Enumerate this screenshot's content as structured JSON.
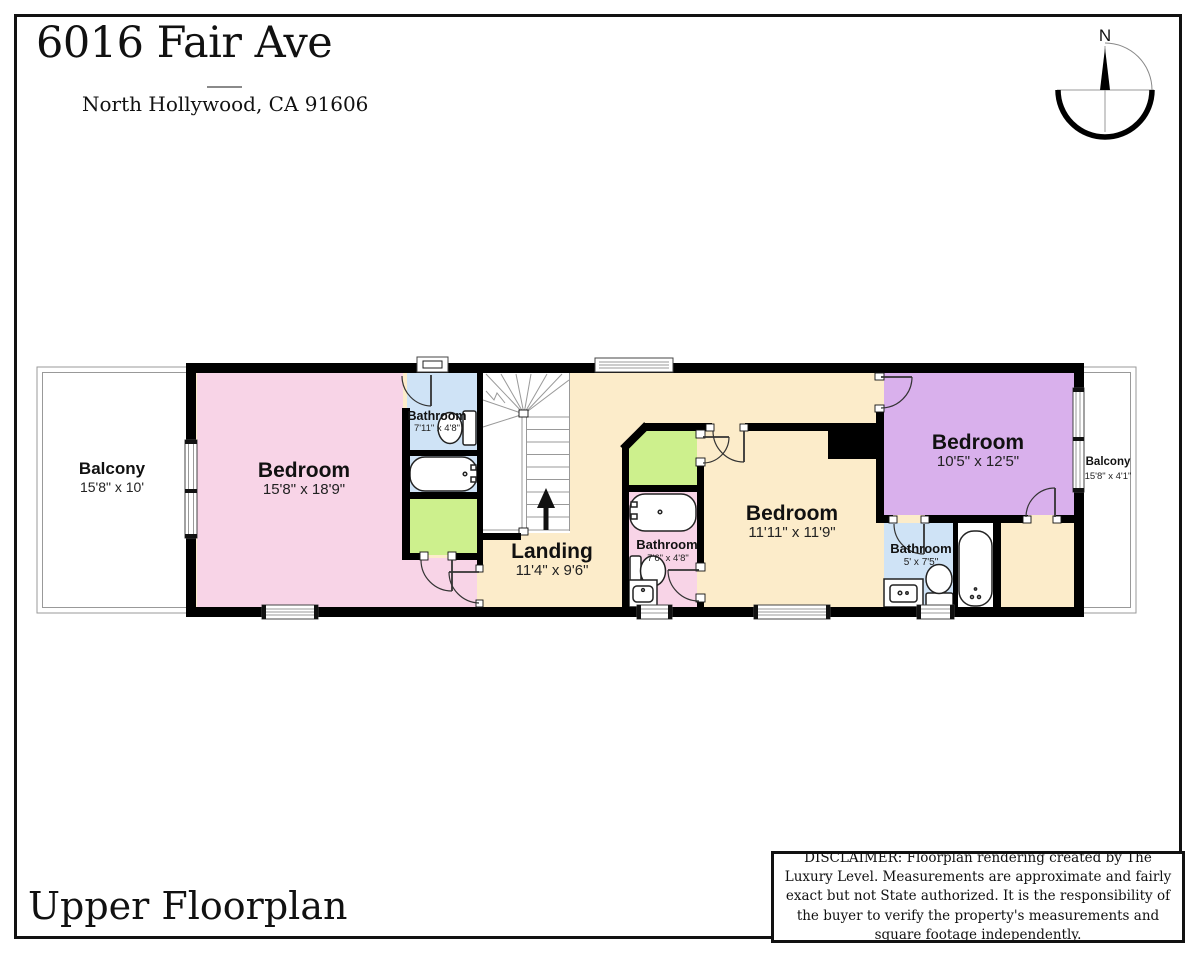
{
  "header": {
    "title": "6016 Fair Ave",
    "subtitle": "North Hollywood, CA 91606",
    "compass_n": "N"
  },
  "footer": {
    "floor_label": "Upper Floorplan",
    "disclaimer": "DISCLAIMER: Floorplan rendering created by The Luxury Level. Measurements are approximate and fairly exact but not State authorized. It is the responsibility of the buyer to verify the property's measurements and square footage independently."
  },
  "rooms": {
    "balcony_left": {
      "name": "Balcony",
      "dims": "15'8\" x 10'"
    },
    "bedroom_left": {
      "name": "Bedroom",
      "dims": "15'8\" x 18'9\""
    },
    "bathroom_left": {
      "name": "Bathroom",
      "dims": "7'11\" x 4'8\""
    },
    "landing": {
      "name": "Landing",
      "dims": "11'4\" x 9'6\""
    },
    "bathroom_middle": {
      "name": "Bathroom",
      "dims": "7'6\" x 4'8\""
    },
    "bedroom_middle": {
      "name": "Bedroom",
      "dims": "11'11\" x 11'9\""
    },
    "bedroom_right": {
      "name": "Bedroom",
      "dims": "10'5\" x 12'5\""
    },
    "bathroom_right": {
      "name": "Bathroom",
      "dims": "5' x 7'5\""
    },
    "balcony_right": {
      "name": "Balcony",
      "dims": "15'8\" x 4'1\""
    }
  },
  "colors": {
    "wall": "#000000",
    "bedroom_pink": "#f8d4e7",
    "floor_tan": "#fcecca",
    "bedroom_purple": "#d9b0ec",
    "bathroom_blue": "#cfe3f6",
    "closet_green": "#cdf08d",
    "stairs_white": "#ffffff"
  }
}
